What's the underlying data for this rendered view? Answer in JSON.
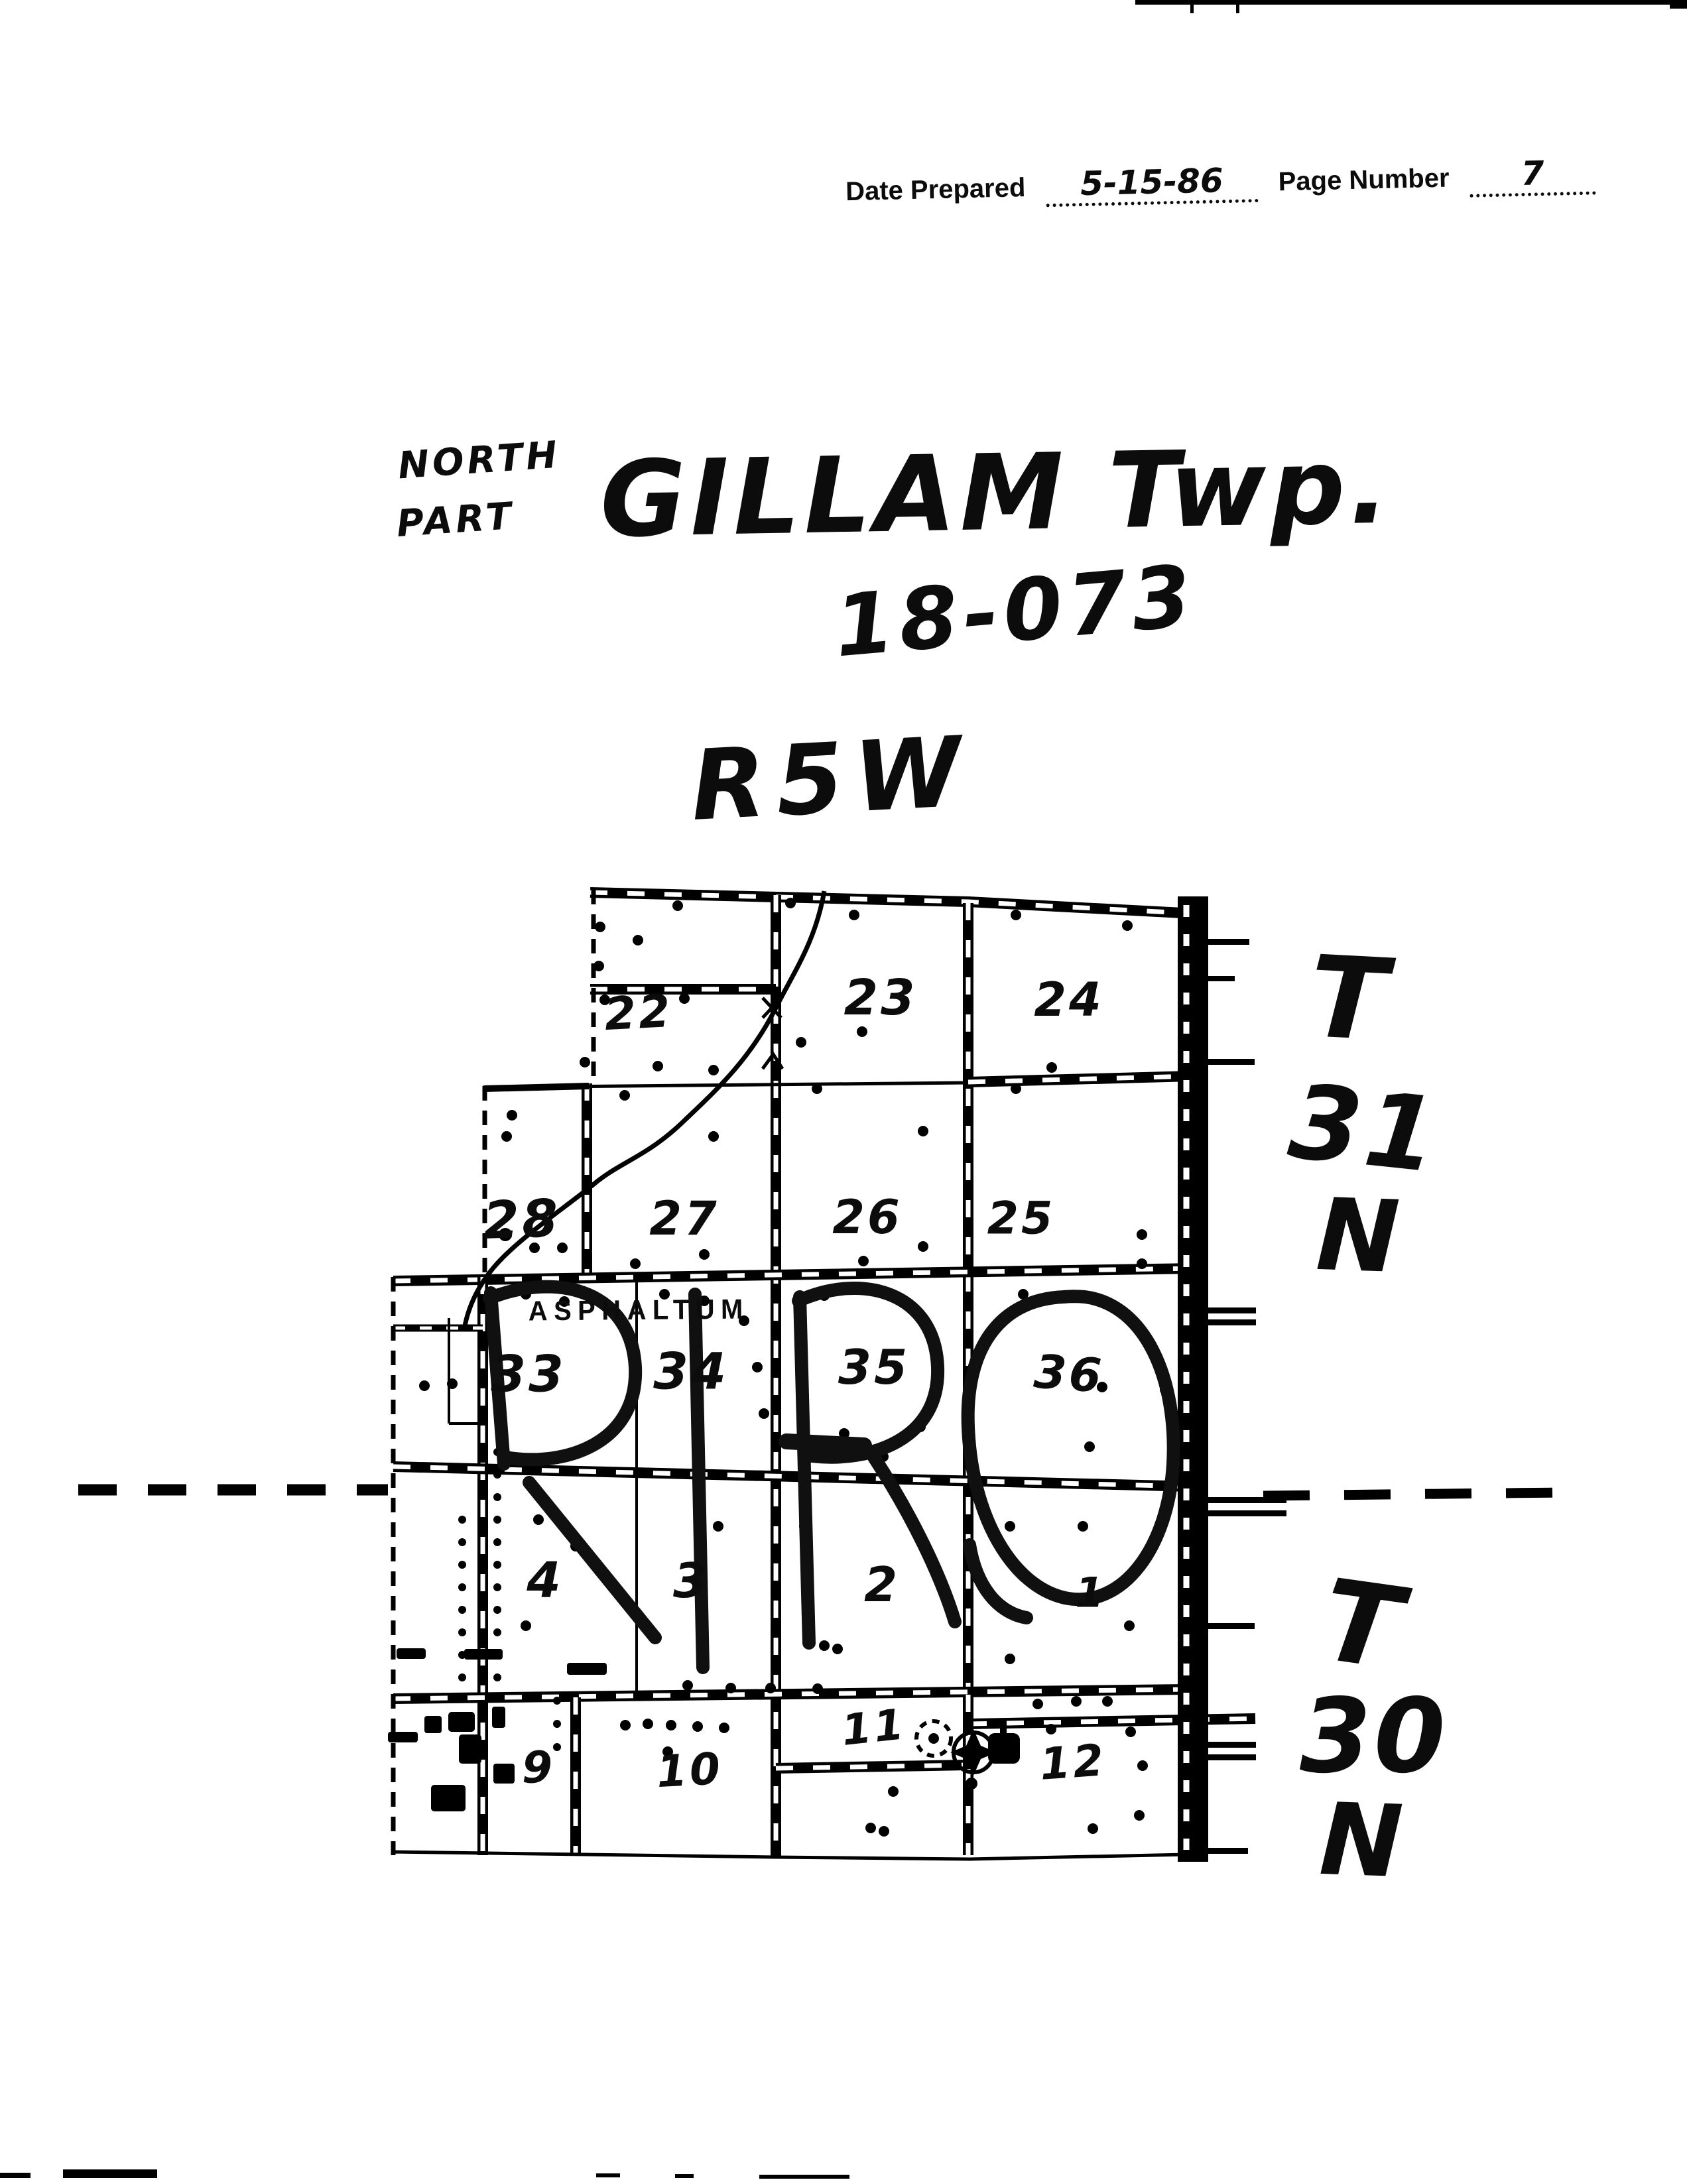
{
  "page": {
    "background": "#ffffff",
    "ink": "#0c0c0c"
  },
  "header": {
    "date_prepared_label": "Date Prepared",
    "date_prepared_value": "5-15-86",
    "page_number_label": "Page Number",
    "page_number_value": "7"
  },
  "title": {
    "part_top": "NORTH",
    "part_bottom": "PART",
    "township": "GILLAM Twp.",
    "map_code": "18-073",
    "range": "R5W"
  },
  "township_grid": {
    "north": {
      "letter_t": "T",
      "number": "31",
      "letter_n": "N"
    },
    "south": {
      "letter_t": "T",
      "number": "30",
      "letter_n": "N"
    }
  },
  "map": {
    "area_label": "ASPHALTUM",
    "overlay_word": "PIRO",
    "sections": [
      "22",
      "23",
      "24",
      "28",
      "27",
      "26",
      "25",
      "33",
      "34",
      "35",
      "36",
      "4",
      "3",
      "2",
      "1",
      "9",
      "10",
      "11",
      "12"
    ]
  }
}
